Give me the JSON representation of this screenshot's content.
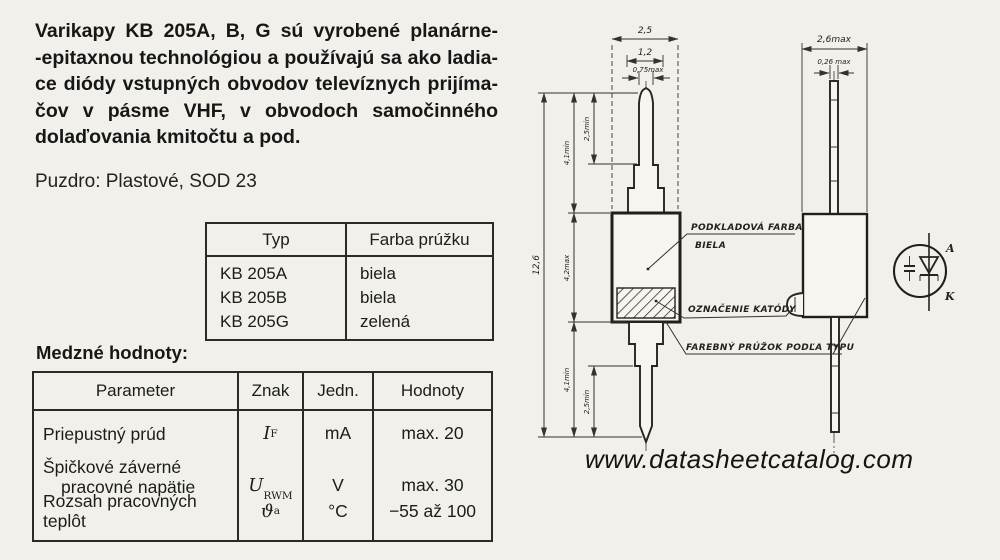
{
  "colors": {
    "paper": "#f1f0ea",
    "ink": "#1c1c1c"
  },
  "intro": {
    "lines": [
      "Varikapy KB 205A, B, G sú vyrobené planárne-",
      "-epitaxnou technológiou a používajú sa ako ladia-",
      "ce diódy vstupných obvodov televíznych prijíma-",
      "čov v pásme VHF, v obvodoch samočinného",
      "dolaďovania kmitočtu a pod."
    ]
  },
  "package_line": "Puzdro: Plastové, SOD 23",
  "type_table": {
    "headers": [
      "Typ",
      "Farba prúžku"
    ],
    "rows": [
      [
        "KB 205A",
        "biela"
      ],
      [
        "KB 205B",
        "biela"
      ],
      [
        "KB 205G",
        "zelená"
      ]
    ]
  },
  "limits": {
    "title": "Medzné hodnoty:",
    "headers": [
      "Parameter",
      "Znak",
      "Jedn.",
      "Hodnoty"
    ],
    "rows": [
      {
        "param_lines": [
          "Priepustný prúd",
          ""
        ],
        "symbol": "I",
        "sub": "F",
        "unit": "mA",
        "value": "max. 20"
      },
      {
        "param_lines": [
          "Špičkové záverné",
          "pracovné napätie"
        ],
        "symbol": "U",
        "sub": "RWM",
        "unit": "V",
        "value": "max. 30"
      },
      {
        "param_lines": [
          "Rozsah pracovných teplôt",
          ""
        ],
        "symbol": "ϑ",
        "sub": "a",
        "unit": "°C",
        "value": "−55 až 100"
      }
    ]
  },
  "drawing": {
    "front_view": {
      "dim_width": "2,5",
      "dim_step": "1,2",
      "dim_lead": "0,75max",
      "dim_total": "12,6",
      "dim_top_lead": "4,1min",
      "dim_top_inner": "2,5min",
      "dim_body": "4,2max",
      "dim_bottom_lead": "4,1min",
      "dim_bottom_inner": "2,5min"
    },
    "side_view": {
      "dim_width": "2,6max",
      "dim_lead": "0,26 max"
    },
    "labels": {
      "base_color_1": "PODKLADOVÁ FARBA",
      "base_color_2": "BIELA",
      "cathode_mark": "OZNAČENIE KATÓDY",
      "stripe": "FAREBNÝ PRÚŽOK PODĽA TYPU"
    },
    "symbol": {
      "anode": "A",
      "cathode": "K"
    }
  },
  "watermark": "www.datasheetcatalog.com"
}
